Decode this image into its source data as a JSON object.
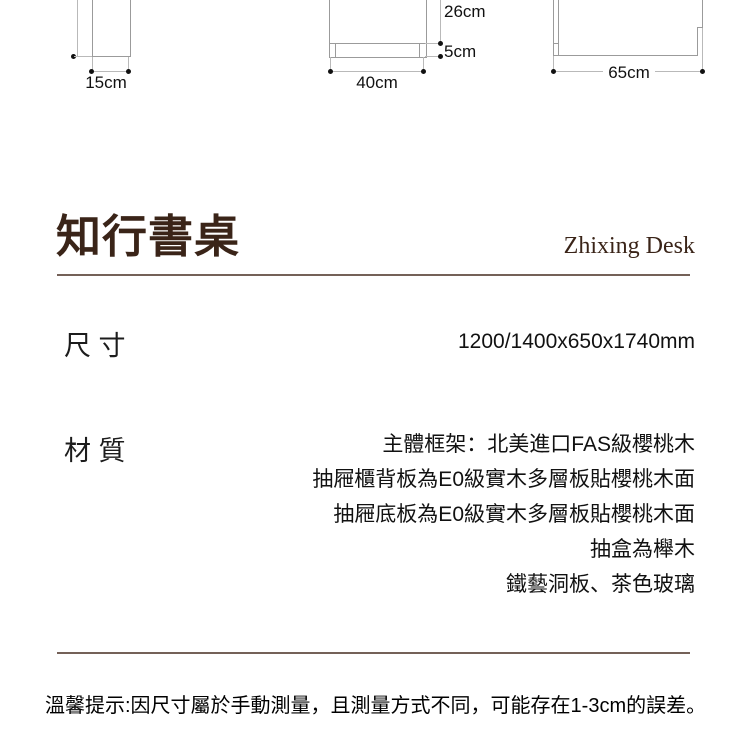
{
  "colors": {
    "accent_brown": "#3a2418",
    "divider_brown": "#746158",
    "drawing_line_gray": "#9b9b9b",
    "dimension_line_gray": "#b9b9b9",
    "text_black": "#111111"
  },
  "drawings": {
    "left_side_view": {
      "width_label": "15cm"
    },
    "middle_front_view": {
      "width_label": "40cm",
      "upper_height_label": "26cm",
      "plinth_height_label": "5cm"
    },
    "right_side_view": {
      "depth_label": "65cm"
    }
  },
  "title": {
    "zh": "知行書桌",
    "en": "Zhixing Desk"
  },
  "specs": {
    "size": {
      "label": "尺 寸",
      "value": "1200/1400x650x1740mm"
    },
    "material": {
      "label": "材 質",
      "lines": [
        "主體框架：北美進口FAS級櫻桃木",
        "抽屜櫃背板為E0級實木多層板貼櫻桃木面",
        "抽屜底板為E0級實木多層板貼櫻桃木面",
        "抽盒為櫸木",
        "鐵藝洞板、茶色玻璃"
      ]
    }
  },
  "footer": {
    "tip": "溫馨提示:因尺寸屬於手動測量，且測量方式不同，可能存在1-3cm的誤差。"
  }
}
